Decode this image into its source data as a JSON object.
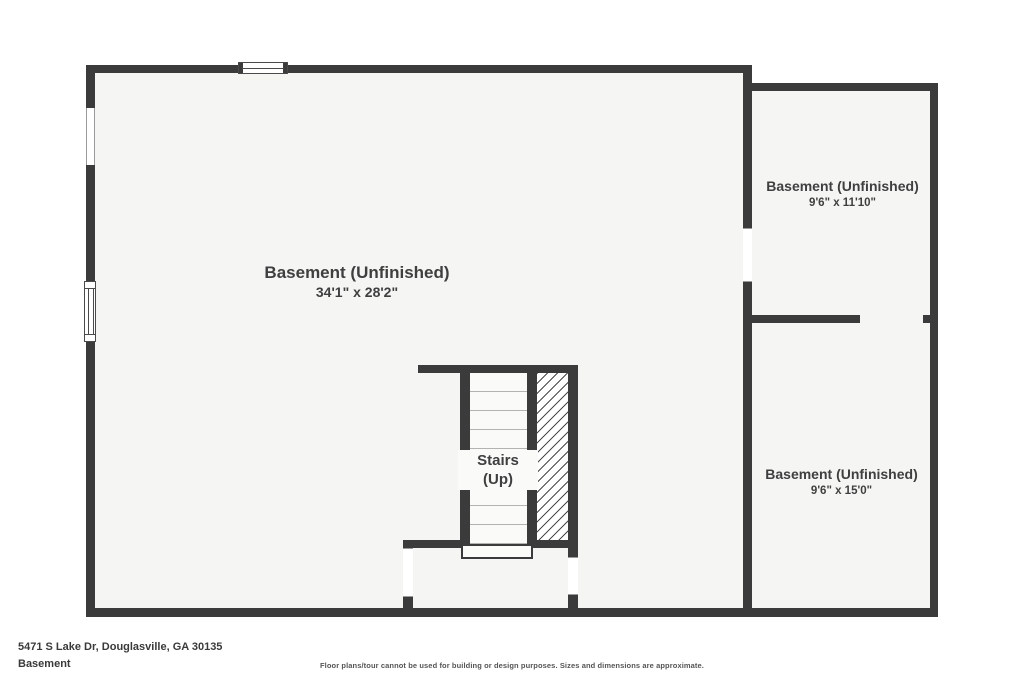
{
  "floorplan": {
    "rooms": {
      "main": {
        "name": "Basement (Unfinished)",
        "dims": "34'1\" x 28'2\""
      },
      "upper_right": {
        "name": "Basement (Unfinished)",
        "dims": "9'6\" x 11'10\""
      },
      "lower_right": {
        "name": "Basement (Unfinished)",
        "dims": "9'6\" x 15'0\""
      }
    },
    "stairs": {
      "line1": "Stairs",
      "line2": "(Up)"
    }
  },
  "footer": {
    "address": "5471 S Lake Dr, Douglasville, GA 30135",
    "level": "Basement",
    "disclaimer": "Floor plans/tour cannot be used for building or design purposes. Sizes and dimensions are approximate."
  },
  "colors": {
    "wall": "#3b3b3b",
    "floor": "#f5f5f3",
    "background": "#ffffff",
    "text": "#3f3f3f",
    "tread_line": "#b3b3b3",
    "hatch_line": "#4a4a4a"
  }
}
